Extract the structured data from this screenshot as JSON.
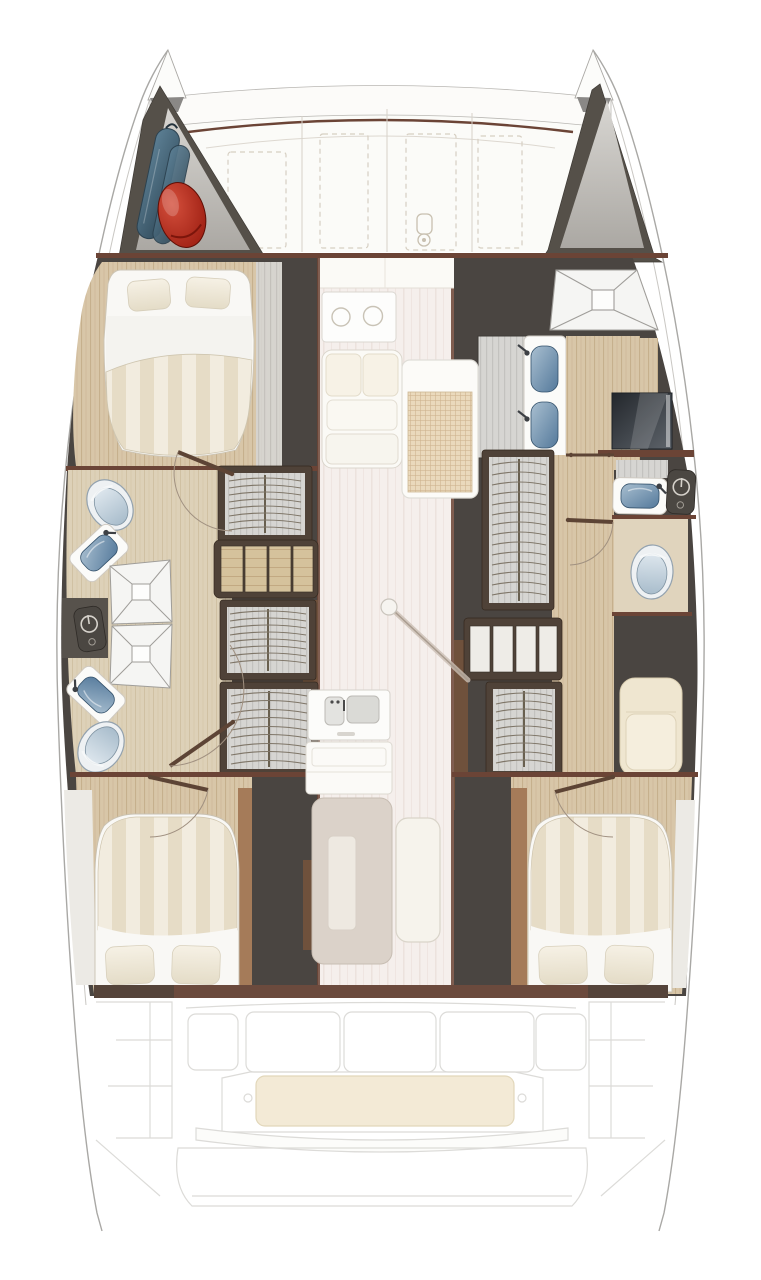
{
  "title": "Catamaran interior layout floor plan, top-down view, bow up",
  "vessel": {
    "type": "catamaran",
    "view": "deck-plan",
    "orientation": "bow-up"
  },
  "palette": {
    "hull_line": "#a9a8a5",
    "deck_white": "#fbfbf8",
    "trim_maroon": "#6b4436",
    "wall_dark": "#4a4541",
    "frame_dark": "#4f4238",
    "wood_floor": "#d8c6a8",
    "wood_floor_pale": "#ded2ba",
    "saloon_floor": "#f5efec",
    "duvet_stripe_a": "#f2ecdf",
    "duvet_stripe_b": "#e6dcc6",
    "mattress_white": "#f9f8f5",
    "pillow": "#f0ebdd",
    "wardrobe_gray": "#d6d5d2",
    "hanger_line": "#7e7567",
    "shower_white": "#f5f5f3",
    "tile_grid": "#ead9bc",
    "sink_blue": "#54799b",
    "toilet_gray_blue": "#a9bdcc",
    "bench_cream": "#efe6d0",
    "tv_dark": "#2b3036",
    "bag_blue": "#49697d",
    "bag_red": "#b3271b",
    "unit_dark": "#4b4742",
    "faint_outline": "#dcdbd8"
  },
  "rooms": {
    "bow": {
      "port_locker_items": [
        "sail-bags-blue",
        "fender-red"
      ],
      "starboard_locker_items": [],
      "foredeck_hatches": 4,
      "windlass": 1
    },
    "port_hull": {
      "forward": [
        "double-bed"
      ],
      "mid": [
        "toilet",
        "washbasin",
        "shower-pan",
        "equipment-unit",
        "shower-pan",
        "washbasin",
        "toilet",
        "wardrobe",
        "companionway-steps",
        "wardrobe",
        "wardrobe",
        "doors"
      ],
      "aft": [
        "double-bed"
      ]
    },
    "starboard_hull": {
      "forward": [
        "shower-pan-large",
        "double-vanity-basins",
        "tv-screen",
        "louvre-cabinet"
      ],
      "mid": [
        "wardrobe",
        "washbasin",
        "equipment-unit",
        "toilet",
        "shelf-unit",
        "wardrobe",
        "seat-bench-cream",
        "doors"
      ],
      "aft": [
        "double-bed"
      ]
    },
    "saloon": [
      "forward-seat-back",
      "stove-counter",
      "sofa",
      "tiled-mat",
      "mast-post",
      "galley-double-sink",
      "galley-counter",
      "table",
      "bench-seat"
    ],
    "cockpit": [
      "locker-panels-3",
      "aft-bench-cushion",
      "cup-holders-2",
      "swim-platform",
      "transom-steps"
    ]
  }
}
